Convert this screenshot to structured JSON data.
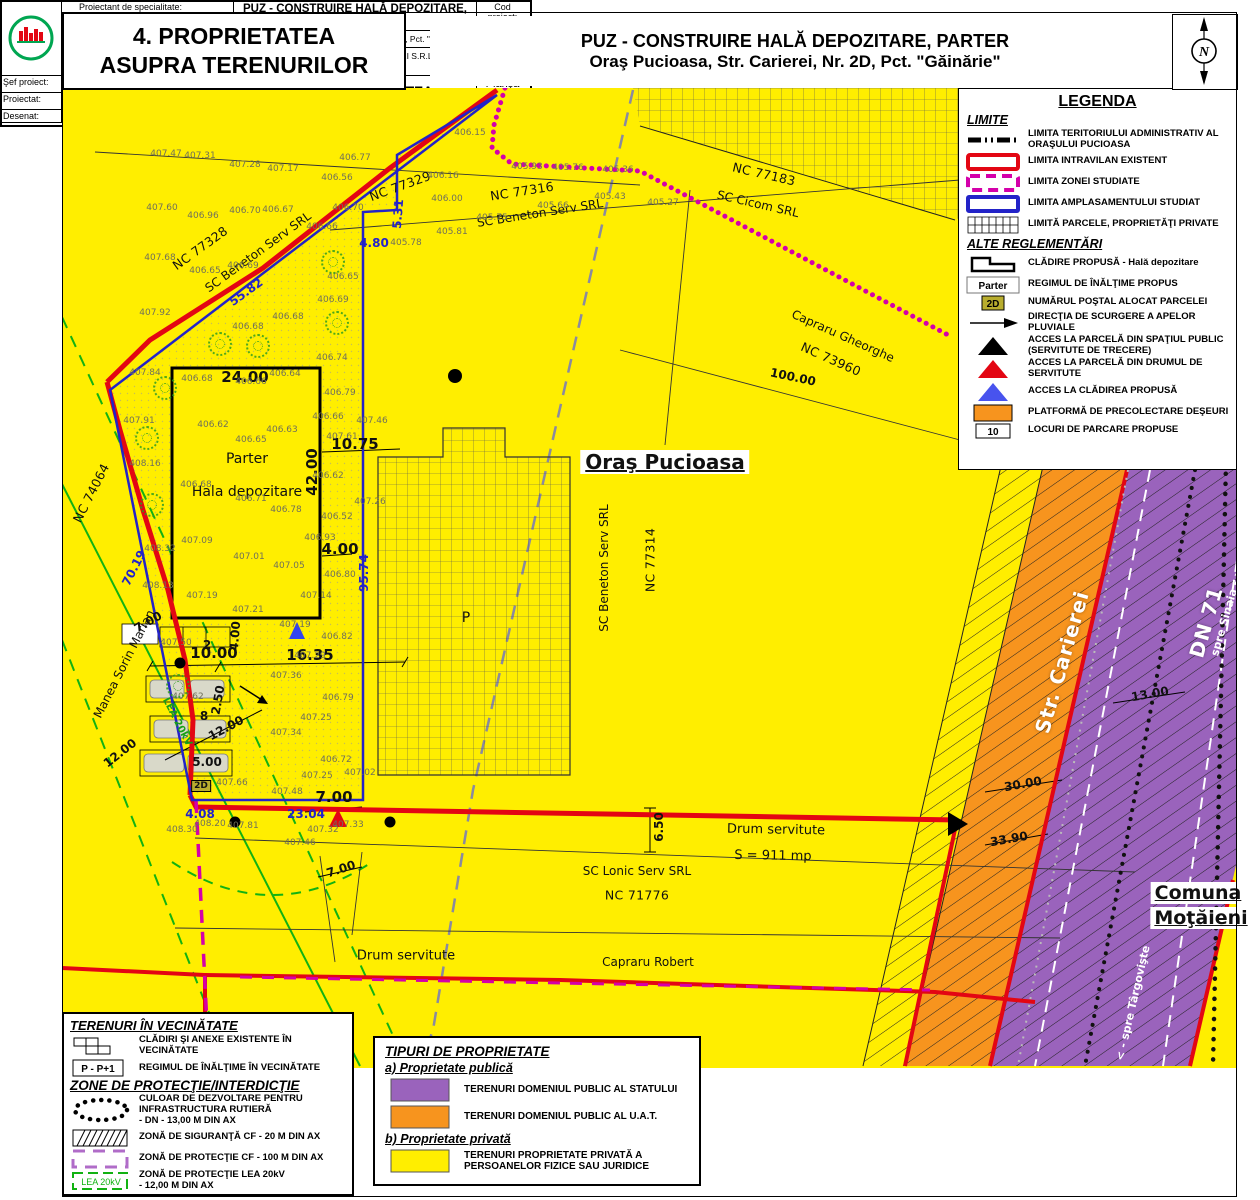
{
  "header": {
    "title_line1": "4. PROPRIETATEA",
    "title_line2": "ASUPRA TERENURILOR",
    "project_line1": "PUZ - CONSTRUIRE HALĂ DEPOZITARE, PARTER",
    "project_line2": "Oraş Pucioasa, Str. Carierei, Nr. 2D, Pct. \"Găinărie\"",
    "north_letter": "N"
  },
  "colors": {
    "map_yellow": "#FFEE00",
    "orange": "#F7941E",
    "purple": "#9A63BC",
    "red": "#E30613",
    "magenta": "#D400AA",
    "blue": "#2323C8",
    "green": "#1FA01F"
  },
  "legend": {
    "title": "LEGENDA",
    "limite_heading": "LIMITE",
    "alte_heading": "ALTE REGLEMENTĂRI",
    "limite_items": [
      {
        "sym": "admin",
        "label": "LIMITA TERITORIULUI ADMINISTRATIV AL ORAŞULUI PUCIOASA"
      },
      {
        "sym": "red-rect",
        "label": "LIMITA INTRAVILAN EXISTENT"
      },
      {
        "sym": "magenta-rect",
        "label": "LIMITA ZONEI STUDIATE"
      },
      {
        "sym": "blue-rect",
        "label": "LIMITA AMPLASAMENTULUI STUDIAT"
      },
      {
        "sym": "grid-rect",
        "label": "LIMITĂ PARCELE, PROPRIETĂŢI PRIVATE"
      }
    ],
    "alte_items": [
      {
        "sym": "building",
        "label": "CLĂDIRE PROPUSĂ - Hală depozitare"
      },
      {
        "sym": "parter",
        "label": "REGIMUL DE ÎNĂLŢIME PROPUS",
        "symtext": "Parter"
      },
      {
        "sym": "badge2d",
        "label": "NUMĂRUL POŞTAL ALOCAT PARCELEI",
        "symtext": "2D"
      },
      {
        "sym": "arrow",
        "label": "DIRECŢIA DE SCURGERE A APELOR PLUVIALE"
      },
      {
        "sym": "tri-black",
        "label": "ACCES LA PARCELĂ DIN SPAŢIUL PUBLIC (SERVITUTE DE TRECERE)"
      },
      {
        "sym": "tri-red",
        "label": "ACCES LA PARCELĂ DIN DRUMUL DE SERVITUTE"
      },
      {
        "sym": "tri-blue",
        "label": "ACCES LA CLĂDIREA PROPUSĂ"
      },
      {
        "sym": "orange-rect",
        "label": "PLATFORMĂ DE PRECOLECTARE DEŞEURI"
      },
      {
        "sym": "box10",
        "label": "LOCURI DE PARCARE PROPUSE",
        "symtext": "10"
      }
    ]
  },
  "vec_panel": {
    "title": "TERENURI ÎN VECINĂTATE",
    "items": [
      {
        "sym": "blocks",
        "label": "CLĂDIRI ŞI ANEXE EXISTENTE  ÎN VECINĂTATE"
      },
      {
        "sym": "pp1",
        "label": "REGIMUL DE ÎNĂLŢIME ÎN VECINĂTATE",
        "symtext": "P - P+1"
      }
    ],
    "zone_title": "ZONE DE PROTECŢIE/INTERDICŢIE",
    "zone_items": [
      {
        "sym": "dots-ellipse",
        "label": "CULOAR DE DEZVOLTARE PENTRU INFRASTRUCTURA RUTIERĂ\n- DN - 13,00 M DIN AX"
      },
      {
        "sym": "hatch-rect",
        "label": "ZONĂ DE SIGURANŢĂ CF - 20 M DIN AX"
      },
      {
        "sym": "cf-dash",
        "label": "ZONĂ DE PROTECŢIE CF - 100 M DIN AX"
      },
      {
        "sym": "lea",
        "label": "ZONĂ DE PROTECŢIE LEA 20kV\n- 12,00 M DIN AX",
        "symtext": "LEA 20kV"
      }
    ]
  },
  "tip_panel": {
    "title": "TIPURI DE PROPRIETATE",
    "a_heading": "a) Proprietate publică",
    "a_items": [
      {
        "sym": "sw-purple",
        "label": "TERENURI DOMENIUL PUBLIC AL STATULUI"
      },
      {
        "sym": "sw-orange",
        "label": "TERENURI DOMENIUL PUBLIC AL U.A.T."
      }
    ],
    "b_heading": "b) Proprietate privată",
    "b_items": [
      {
        "sym": "sw-yellow",
        "label": "TERENURI PROPRIETATE PRIVATĂ A PERSOANELOR FIZICE SAU JURIDICE"
      }
    ]
  },
  "title_block": {
    "proiectant_label": "Proiectant de specialitate:",
    "company": "S.C. MIRUNA GISCONCEPT S.R.L.",
    "telfax": "Tel./Fax: +40(0)245 212 909",
    "mobil": "Mobil: +40(0)734 722 655",
    "email": "mirunagisconcept@yahoo.com",
    "project_title": "PUZ - CONSTRUIRE HALĂ DEPOZITARE, PARTER",
    "adresa_label": "Adresa:",
    "adresa": "Oraş Pucioasa, Str. Carierei, Nr. 2D, Pct. \"Găinărie\"",
    "beneficiar_label": "Beneficiar:",
    "beneficiar": "S.C COOL STORAGE PIETRARI S.R.L.",
    "cod_label": "Cod proiect:",
    "cod": "Z643",
    "faza_label": "Faza:",
    "faza": "P.U.Z.",
    "sef_label": "Şef proiect:",
    "proiectat_label": "Proiectat:",
    "desenat_label": "Desenat:",
    "sef_value": "Urb. Miruna Chiriţescu",
    "desenat_value": "Oper. Nicoleta Orboiu",
    "scara_label": "Scara:",
    "scara": "1: 500",
    "data_label": "Data:",
    "data": "2025",
    "sheet_title": "PROPRIETATEA ASUPRA TERENURILOR",
    "plansa_label": "Planşa",
    "plansa_nr": "4"
  },
  "map": {
    "texts": [
      {
        "t": "NC 77329",
        "x": 400,
        "y": 186,
        "r": -20,
        "c": "nc"
      },
      {
        "t": "NC 77316",
        "x": 522,
        "y": 191,
        "r": -9,
        "c": "nc"
      },
      {
        "t": "SC Beneton Serv SRL",
        "x": 540,
        "y": 213,
        "r": -9,
        "c": "nm"
      },
      {
        "t": "NC 77328",
        "x": 200,
        "y": 248,
        "r": -36,
        "c": "nc"
      },
      {
        "t": "SC Beneton Serv SRL",
        "x": 258,
        "y": 252,
        "r": -36,
        "c": "nm"
      },
      {
        "t": "55.82",
        "x": 246,
        "y": 292,
        "r": -36,
        "c": "bl"
      },
      {
        "t": "NC 77183",
        "x": 764,
        "y": 174,
        "r": 13,
        "c": "nc"
      },
      {
        "t": "SC Cicom SRL",
        "x": 758,
        "y": 204,
        "r": 13,
        "c": "nm"
      },
      {
        "t": "Capraru Gheorghe",
        "x": 843,
        "y": 336,
        "r": 24,
        "c": "nm"
      },
      {
        "t": "NC 73960",
        "x": 831,
        "y": 359,
        "r": 24,
        "c": "nc"
      },
      {
        "t": "100.00",
        "x": 793,
        "y": 377,
        "r": 12,
        "c": "dim"
      },
      {
        "t": "Oraş Pucioasa",
        "x": 665,
        "y": 462,
        "r": 0,
        "c": "city"
      },
      {
        "t": "SC Beneton Serv SRL",
        "x": 604,
        "y": 568,
        "r": -90,
        "c": "nm"
      },
      {
        "t": "NC 77314",
        "x": 650,
        "y": 560,
        "r": -90,
        "c": "nc"
      },
      {
        "t": "NC 74064",
        "x": 91,
        "y": 493,
        "r": -63,
        "c": "nc"
      },
      {
        "t": "Manea Sorin Marian",
        "x": 124,
        "y": 664,
        "r": -63,
        "c": "nm"
      },
      {
        "t": "70.19",
        "x": 134,
        "y": 568,
        "r": -63,
        "c": "bl"
      },
      {
        "t": "95.74",
        "x": 364,
        "y": 573,
        "r": -90,
        "c": "bl"
      },
      {
        "t": "5.31",
        "x": 398,
        "y": 214,
        "r": -85,
        "c": "bl"
      },
      {
        "t": "4.80",
        "x": 374,
        "y": 243,
        "r": 0,
        "c": "bl"
      },
      {
        "t": "4.08",
        "x": 200,
        "y": 814,
        "r": 0,
        "c": "bl"
      },
      {
        "t": "23.04",
        "x": 306,
        "y": 814,
        "r": 0,
        "c": "bl"
      },
      {
        "t": "Parter",
        "x": 247,
        "y": 459,
        "r": 0,
        "c": "bld"
      },
      {
        "t": "Hala depozitare",
        "x": 247,
        "y": 492,
        "r": 0,
        "c": "bld"
      },
      {
        "t": "P",
        "x": 466,
        "y": 618,
        "r": 0,
        "c": "bld"
      },
      {
        "t": "24.00",
        "x": 245,
        "y": 377,
        "r": 0,
        "c": "dimL"
      },
      {
        "t": "42.00",
        "x": 312,
        "y": 472,
        "r": -90,
        "c": "dimL"
      },
      {
        "t": "10.75",
        "x": 355,
        "y": 444,
        "r": 0,
        "c": "dimL"
      },
      {
        "t": "4.00",
        "x": 340,
        "y": 549,
        "r": 0,
        "c": "dimL"
      },
      {
        "t": "16.35",
        "x": 310,
        "y": 655,
        "r": 0,
        "c": "dimL"
      },
      {
        "t": "10.00",
        "x": 214,
        "y": 653,
        "r": 0,
        "c": "dimL"
      },
      {
        "t": "4.00",
        "x": 235,
        "y": 636,
        "r": -85,
        "c": "dim"
      },
      {
        "t": "2.50",
        "x": 218,
        "y": 700,
        "r": -80,
        "c": "dim"
      },
      {
        "t": "12.00",
        "x": 226,
        "y": 728,
        "r": -28,
        "c": "dim"
      },
      {
        "t": "5.00",
        "x": 207,
        "y": 762,
        "r": 0,
        "c": "dim"
      },
      {
        "t": "12.00",
        "x": 120,
        "y": 753,
        "r": -38,
        "c": "dim"
      },
      {
        "t": "7.00",
        "x": 148,
        "y": 622,
        "r": -30,
        "c": "dim"
      },
      {
        "t": "7.00",
        "x": 334,
        "y": 797,
        "r": 0,
        "c": "dimL"
      },
      {
        "t": "7.00",
        "x": 341,
        "y": 869,
        "r": -18,
        "c": "dim"
      },
      {
        "t": "6.50",
        "x": 659,
        "y": 827,
        "r": -90,
        "c": "dim"
      },
      {
        "t": "Drum servitute",
        "x": 776,
        "y": 830,
        "r": 1,
        "c": "drum"
      },
      {
        "t": "S = 911 mp",
        "x": 773,
        "y": 856,
        "r": 1,
        "c": "drum"
      },
      {
        "t": "SC Lonic Serv SRL",
        "x": 637,
        "y": 871,
        "r": 0,
        "c": "nm"
      },
      {
        "t": "NC 71776",
        "x": 637,
        "y": 895,
        "r": 0,
        "c": "nc"
      },
      {
        "t": "Capraru Robert",
        "x": 648,
        "y": 962,
        "r": 0,
        "c": "nm"
      },
      {
        "t": "Drum servitute",
        "x": 406,
        "y": 956,
        "r": 0,
        "c": "drum"
      },
      {
        "t": "Str. Carierei",
        "x": 1062,
        "y": 662,
        "r": -74,
        "c": "wb"
      },
      {
        "t": "DN 71",
        "x": 1206,
        "y": 622,
        "r": -74,
        "c": "wb"
      },
      {
        "t": "spre Sinaia - >",
        "x": 1227,
        "y": 612,
        "r": -74,
        "c": "ws"
      },
      {
        "t": "< - spre Târgovişte",
        "x": 1133,
        "y": 1003,
        "r": -77,
        "c": "ws"
      },
      {
        "t": "30.00",
        "x": 1023,
        "y": 784,
        "r": -10,
        "c": "dim"
      },
      {
        "t": "33.90",
        "x": 1009,
        "y": 839,
        "r": -10,
        "c": "dim"
      },
      {
        "t": "13.00",
        "x": 1150,
        "y": 694,
        "r": -10,
        "c": "dim"
      },
      {
        "t": "2",
        "x": 207,
        "y": 645,
        "r": 0,
        "c": "dim"
      },
      {
        "t": "8",
        "x": 204,
        "y": 716,
        "r": 0,
        "c": "dim"
      },
      {
        "t": "2D",
        "x": 201,
        "y": 786,
        "r": 0,
        "c": "b2d"
      },
      {
        "t": "LEA 20kV",
        "x": 177,
        "y": 722,
        "r": 63,
        "c": "grn"
      },
      {
        "t": "Comuna",
        "x": 1198,
        "y": 893,
        "r": 0,
        "c": "com"
      },
      {
        "t": "Moţăieni",
        "x": 1201,
        "y": 918,
        "r": 0,
        "c": "com"
      }
    ],
    "elevations": [
      {
        "t": "407.47",
        "x": 166,
        "y": 154
      },
      {
        "t": "407.31",
        "x": 200,
        "y": 156
      },
      {
        "t": "407.28",
        "x": 245,
        "y": 165
      },
      {
        "t": "407.17",
        "x": 283,
        "y": 169
      },
      {
        "t": "406.77",
        "x": 355,
        "y": 158
      },
      {
        "t": "406.56",
        "x": 337,
        "y": 178
      },
      {
        "t": "406.15",
        "x": 470,
        "y": 133
      },
      {
        "t": "405.93",
        "x": 527,
        "y": 167
      },
      {
        "t": "405.76",
        "x": 568,
        "y": 168
      },
      {
        "t": "405.36",
        "x": 618,
        "y": 170
      },
      {
        "t": "405.43",
        "x": 610,
        "y": 197
      },
      {
        "t": "405.66",
        "x": 553,
        "y": 206
      },
      {
        "t": "405.75",
        "x": 492,
        "y": 218
      },
      {
        "t": "405.81",
        "x": 452,
        "y": 232
      },
      {
        "t": "405.78",
        "x": 406,
        "y": 243
      },
      {
        "t": "406.16",
        "x": 443,
        "y": 176
      },
      {
        "t": "406.00",
        "x": 447,
        "y": 199
      },
      {
        "t": "405.27",
        "x": 663,
        "y": 203
      },
      {
        "t": "407.60",
        "x": 162,
        "y": 208
      },
      {
        "t": "406.96",
        "x": 203,
        "y": 216
      },
      {
        "t": "406.70",
        "x": 245,
        "y": 211
      },
      {
        "t": "406.67",
        "x": 278,
        "y": 210
      },
      {
        "t": "406.70",
        "x": 348,
        "y": 208
      },
      {
        "t": "406.66",
        "x": 322,
        "y": 227
      },
      {
        "t": "407.68",
        "x": 160,
        "y": 258
      },
      {
        "t": "406.65",
        "x": 205,
        "y": 271
      },
      {
        "t": "406.69",
        "x": 243,
        "y": 266
      },
      {
        "t": "406.65",
        "x": 343,
        "y": 277
      },
      {
        "t": "406.69",
        "x": 333,
        "y": 300
      },
      {
        "t": "406.68",
        "x": 288,
        "y": 317
      },
      {
        "t": "406.68",
        "x": 248,
        "y": 327
      },
      {
        "t": "407.92",
        "x": 155,
        "y": 313
      },
      {
        "t": "407.84",
        "x": 145,
        "y": 373
      },
      {
        "t": "407.91",
        "x": 139,
        "y": 421
      },
      {
        "t": "408.16",
        "x": 145,
        "y": 464
      },
      {
        "t": "408.32",
        "x": 160,
        "y": 549
      },
      {
        "t": "408.13",
        "x": 158,
        "y": 586
      },
      {
        "t": "406.68",
        "x": 197,
        "y": 379
      },
      {
        "t": "406.64",
        "x": 285,
        "y": 374
      },
      {
        "t": "406.66",
        "x": 251,
        "y": 382
      },
      {
        "t": "406.74",
        "x": 332,
        "y": 358
      },
      {
        "t": "406.79",
        "x": 340,
        "y": 393
      },
      {
        "t": "406.66",
        "x": 328,
        "y": 417
      },
      {
        "t": "407.46",
        "x": 372,
        "y": 421
      },
      {
        "t": "407.61",
        "x": 342,
        "y": 437
      },
      {
        "t": "406.62",
        "x": 213,
        "y": 425
      },
      {
        "t": "406.63",
        "x": 282,
        "y": 430
      },
      {
        "t": "406.65",
        "x": 251,
        "y": 440
      },
      {
        "t": "406.62",
        "x": 328,
        "y": 476
      },
      {
        "t": "407.26",
        "x": 370,
        "y": 502
      },
      {
        "t": "406.52",
        "x": 337,
        "y": 517
      },
      {
        "t": "406.68",
        "x": 196,
        "y": 485
      },
      {
        "t": "406.71",
        "x": 251,
        "y": 499
      },
      {
        "t": "406.78",
        "x": 286,
        "y": 510
      },
      {
        "t": "406.93",
        "x": 320,
        "y": 538
      },
      {
        "t": "407.09",
        "x": 197,
        "y": 541
      },
      {
        "t": "407.01",
        "x": 249,
        "y": 557
      },
      {
        "t": "407.05",
        "x": 289,
        "y": 566
      },
      {
        "t": "406.80",
        "x": 340,
        "y": 575
      },
      {
        "t": "407.19",
        "x": 202,
        "y": 596
      },
      {
        "t": "407.14",
        "x": 316,
        "y": 596
      },
      {
        "t": "407.21",
        "x": 248,
        "y": 610
      },
      {
        "t": "407.19",
        "x": 295,
        "y": 625
      },
      {
        "t": "407.50",
        "x": 176,
        "y": 643
      },
      {
        "t": "407.62",
        "x": 188,
        "y": 697
      },
      {
        "t": "407.36",
        "x": 286,
        "y": 676
      },
      {
        "t": "406.79",
        "x": 338,
        "y": 698
      },
      {
        "t": "407.25",
        "x": 316,
        "y": 718
      },
      {
        "t": "407.34",
        "x": 286,
        "y": 733
      },
      {
        "t": "406.72",
        "x": 336,
        "y": 760
      },
      {
        "t": "407.25",
        "x": 317,
        "y": 776
      },
      {
        "t": "407.02",
        "x": 360,
        "y": 773
      },
      {
        "t": "407.66",
        "x": 232,
        "y": 783
      },
      {
        "t": "407.48",
        "x": 287,
        "y": 792
      },
      {
        "t": "406.82",
        "x": 337,
        "y": 637
      },
      {
        "t": "407.29",
        "x": 310,
        "y": 656
      },
      {
        "t": "408.30",
        "x": 182,
        "y": 830
      },
      {
        "t": "408.20",
        "x": 210,
        "y": 824
      },
      {
        "t": "407.81",
        "x": 243,
        "y": 826
      },
      {
        "t": "407.32",
        "x": 323,
        "y": 830
      },
      {
        "t": "407.33",
        "x": 348,
        "y": 825
      },
      {
        "t": "407.46",
        "x": 300,
        "y": 843
      }
    ],
    "trees": [
      {
        "x": 220,
        "y": 344
      },
      {
        "x": 258,
        "y": 346
      },
      {
        "x": 333,
        "y": 262
      },
      {
        "x": 337,
        "y": 323
      },
      {
        "x": 165,
        "y": 388
      },
      {
        "x": 147,
        "y": 438
      },
      {
        "x": 152,
        "y": 505
      },
      {
        "x": 178,
        "y": 686
      }
    ]
  }
}
